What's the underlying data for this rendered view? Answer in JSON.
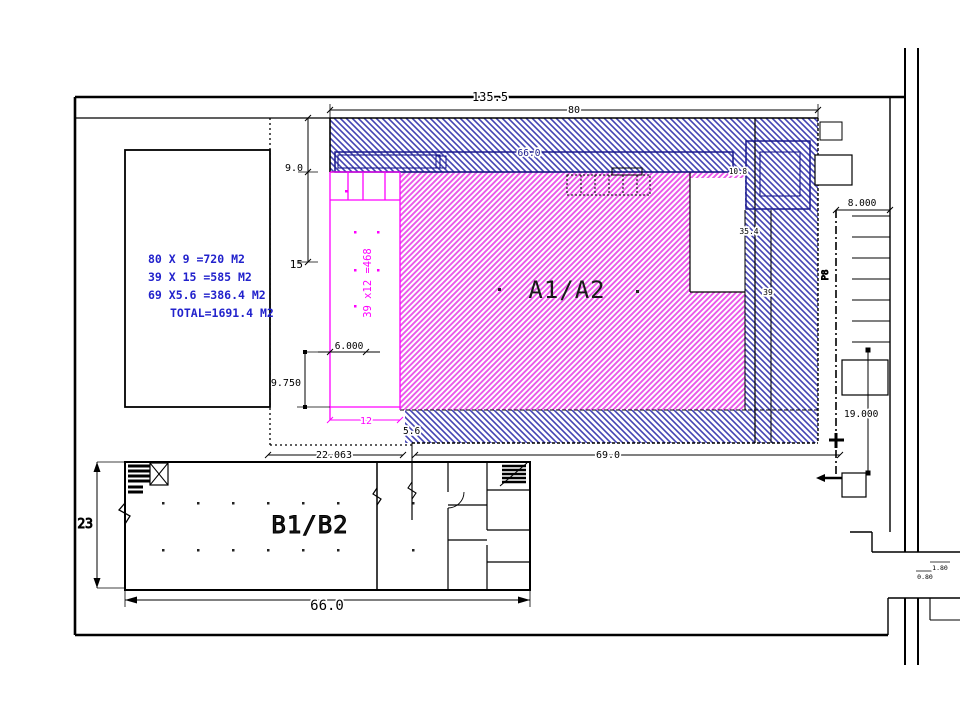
{
  "labels": {
    "area_a": "A1/A2",
    "area_b": "B1/B2",
    "annex_vertical": "39 x12 =468",
    "parking_vertical": "P8"
  },
  "calc": {
    "line1": "80 X 9 =720 M2",
    "line2": "39 X 15 =585 M2",
    "line3": "69 X5.6 =386.4 M2",
    "line4": "TOTAL=1691.4 M2"
  },
  "dims": {
    "site_width": "135.5",
    "a_width": "80",
    "a_top_depth": "9.0",
    "a_mid_depth": "15",
    "band_width": "66.0",
    "inner_width": "6.000",
    "inner_depth": "9.750",
    "annex_width": "12",
    "south_depth": "5.6",
    "west_offset": "22.063",
    "south_width": "69.0",
    "east_a": "35.4",
    "east_b": "39",
    "east_c": "10.8",
    "parking_depth": "8.000",
    "yard_depth": "19.000",
    "b_depth": "23",
    "b_width": "66.0",
    "gate_w1": "1.80",
    "gate_w2": "0.80"
  },
  "colors": {
    "hatch_blue": "#4444b4",
    "hatch_magenta": "#ea5aea",
    "magenta_line": "#ff00ff",
    "calc_text": "#2222cc",
    "band_blue": "#1a1a8c",
    "line_black": "#000000"
  }
}
